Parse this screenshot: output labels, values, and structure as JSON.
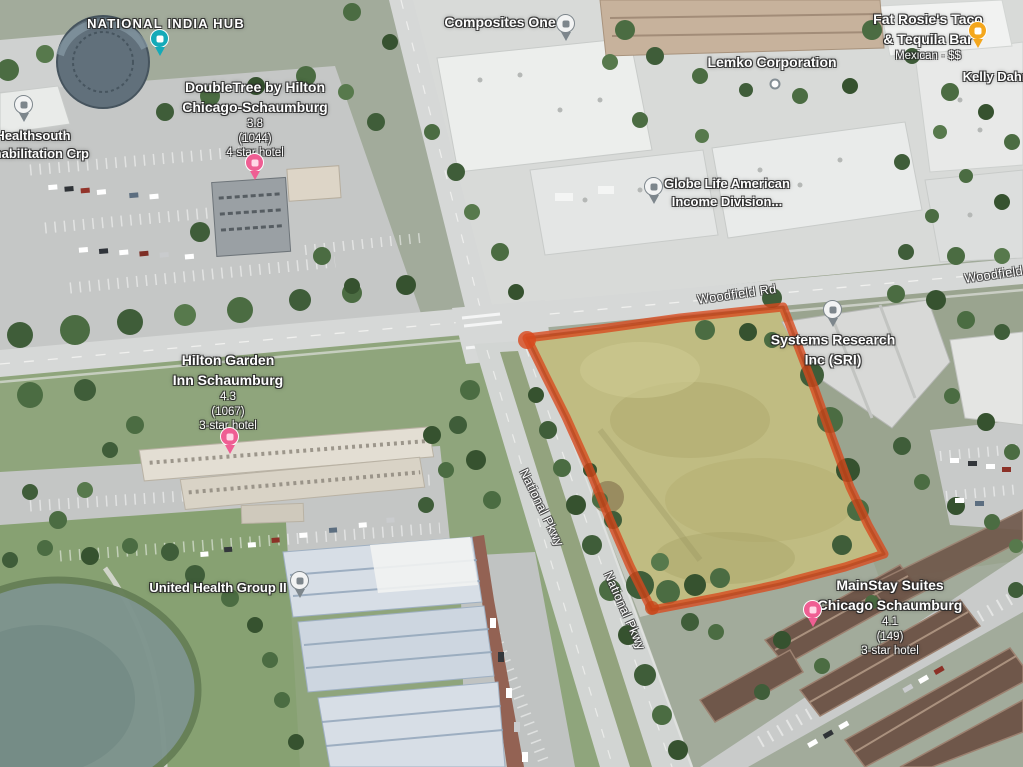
{
  "map": {
    "view": "satellite-3d",
    "highlight_color": "#d8491d",
    "area": "Woodfield Rd & National Pkwy"
  },
  "roads": {
    "woodfield_rd": "Woodfield Rd",
    "national_pkwy": "National Pkwy"
  },
  "places": {
    "national_india_hub": {
      "name": "NATIONAL INDIA HUB",
      "pin_color": "#14aab8"
    },
    "composites_one": {
      "name": "Composites One",
      "pin_color": "#7d868c"
    },
    "fat_rosies": {
      "name_line1": "Fat Rosie's Taco",
      "name_line2": "& Tequila Bar",
      "category": "Mexican · $$",
      "pin_color": "#f4a71d"
    },
    "kelly_dahm": {
      "name": "Kelly Dahm"
    },
    "healthsouth": {
      "name_line1": "Healthsouth",
      "name_line2": "Rehabilitation Crp",
      "pin_color": "#7d868c"
    },
    "doubletree": {
      "name_line1": "DoubleTree by Hilton",
      "name_line2": "Chicago-Schaumburg",
      "rating": "3.8",
      "reviews": "(1044)",
      "category": "4-star hotel",
      "pin_color": "#ef5e93"
    },
    "lemko": {
      "name": "Lemko Corporation",
      "pin_color": "#848e94"
    },
    "globe_life": {
      "name_line1": "Globe Life American",
      "name_line2": "Income Division...",
      "pin_color": "#7d868c"
    },
    "systems_research": {
      "name_line1": "Systems Research",
      "name_line2": "Inc (SRI)",
      "pin_color": "#7d868c"
    },
    "hilton_garden": {
      "name_line1": "Hilton Garden",
      "name_line2": "Inn Schaumburg",
      "rating": "4.3",
      "reviews": "(1067)",
      "category": "3-star hotel",
      "pin_color": "#ef5e93"
    },
    "united_health": {
      "name": "United Health Group II",
      "pin_color": "#7d868c"
    },
    "mainstay": {
      "name_line1": "MainStay Suites",
      "name_line2": "Chicago Schaumburg",
      "rating": "4.1",
      "reviews": "(149)",
      "category": "3-star hotel",
      "pin_color": "#ef5e93"
    }
  }
}
